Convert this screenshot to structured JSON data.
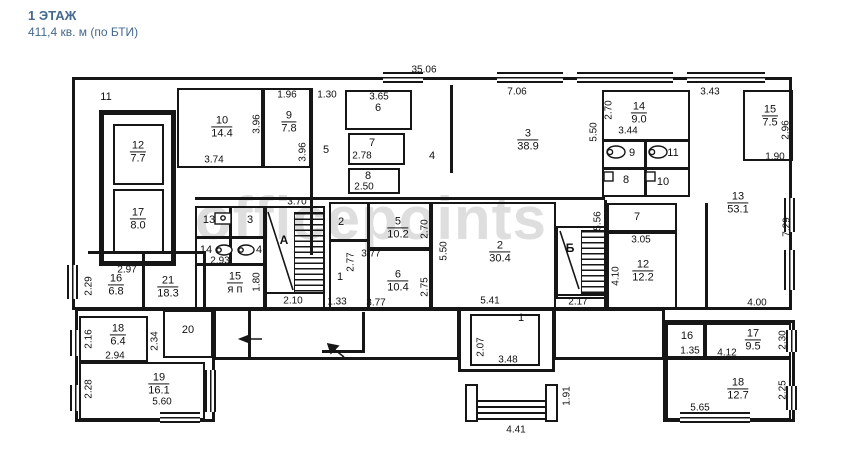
{
  "header": {
    "title": "1 ЭТАЖ",
    "subtitle": "411,4 кв. м (по БТИ)"
  },
  "watermark": "officepoints",
  "stairs": {
    "a": "А",
    "b": "Б"
  },
  "icons": {
    "toilet": "ellipse-with-circle",
    "sink": "small-square",
    "entrance": "arrow-left"
  },
  "rooms": [
    {
      "num": "11"
    },
    {
      "num": "12",
      "area": "7.7"
    },
    {
      "num": "17",
      "area": "8.0"
    },
    {
      "num": "10",
      "area": "14.4"
    },
    {
      "num": "9",
      "area": "7.8"
    },
    {
      "num": "5"
    },
    {
      "num": "6"
    },
    {
      "num": "7"
    },
    {
      "num": "8"
    },
    {
      "num": "4"
    },
    {
      "num": "3",
      "area": "38.9"
    },
    {
      "num": "14",
      "area": "9.0"
    },
    {
      "num": "9"
    },
    {
      "num": "11"
    },
    {
      "num": "8"
    },
    {
      "num": "10"
    },
    {
      "num": "15",
      "area": "7.5"
    },
    {
      "num": "13",
      "area": "53.1"
    },
    {
      "num": "16",
      "area": "6.8"
    },
    {
      "num": "21",
      "area": "18.3"
    },
    {
      "num": "13"
    },
    {
      "num": "3"
    },
    {
      "num": "14"
    },
    {
      "num": "4"
    },
    {
      "num": "15",
      "area": "я п"
    },
    {
      "num": "2"
    },
    {
      "num": "1"
    },
    {
      "num": "5",
      "area": "10.2"
    },
    {
      "num": "6",
      "area": "10.4"
    },
    {
      "num": "2",
      "area": "30.4"
    },
    {
      "num": "7"
    },
    {
      "num": "12",
      "area": "12.2"
    },
    {
      "num": "18",
      "area": "6.4"
    },
    {
      "num": "20"
    },
    {
      "num": "19",
      "area": "16.1"
    },
    {
      "num": "1"
    },
    {
      "num": "16"
    },
    {
      "num": "17",
      "area": "9.5"
    },
    {
      "num": "18",
      "area": "12.7"
    }
  ],
  "dims": [
    "35.06",
    "7.06",
    "1.96",
    "1.30",
    "3.65",
    "3.43",
    "3.96",
    "3.96",
    "3.74",
    "2.78",
    "2.50",
    "2.70",
    "5.50",
    "3.44",
    "2.96",
    "1.90",
    "2.97",
    "2.29",
    "3.70",
    "2.93",
    "1.80",
    "2.10",
    "1.33",
    "3.77",
    "2.70",
    "2.77",
    "3.77",
    "2.75",
    "5.50",
    "5.41",
    "5.56",
    "2.17",
    "3.05",
    "4.10",
    "7.29",
    "4.00",
    "2.07",
    "3.48",
    "1.91",
    "4.41",
    "2.16",
    "2.94",
    "2.34",
    "2.28",
    "5.60",
    "1.35",
    "4.12",
    "2.30",
    "5.65",
    "2.25"
  ]
}
